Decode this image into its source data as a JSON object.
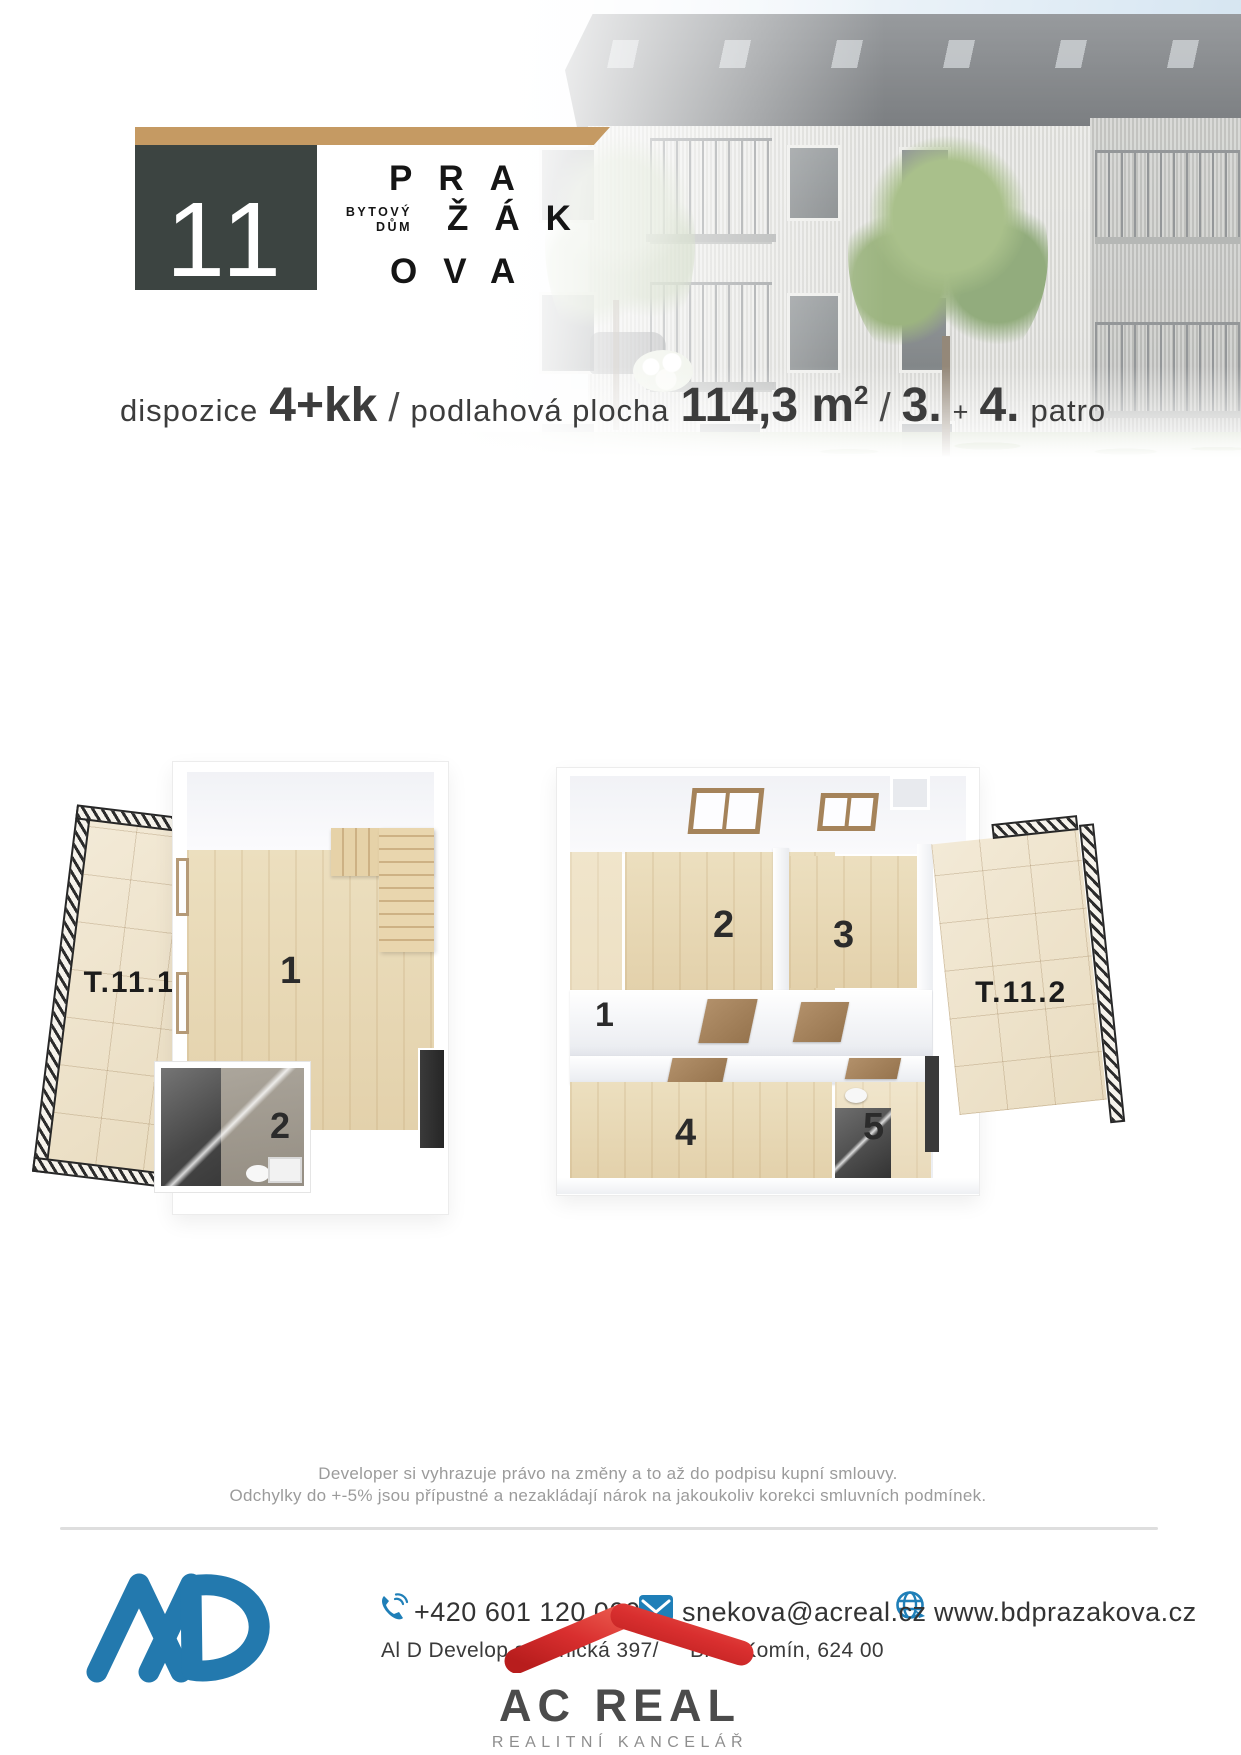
{
  "header": {
    "unit_number": "11",
    "building_type_line1": "BYTOVÝ",
    "building_type_line2": "DŮM",
    "name_row1": "PRA",
    "name_row2": "ŽÁK",
    "name_row3": "OVA",
    "accent_color": "#c59a63",
    "panel_color": "#3c4441"
  },
  "specs": {
    "layout_label": "dispozice",
    "layout_value": "4+kk",
    "slash1": "/",
    "area_label": "podlahová plocha",
    "area_value": "114,3 m",
    "area_exponent": "2",
    "slash2": "/",
    "floor_first": "3.",
    "floor_plus": "+",
    "floor_second": "4.",
    "floor_label": "patro"
  },
  "plans": {
    "terrace1_label": "T.11.1",
    "terrace2_label": "T.11.2",
    "left_room1": "1",
    "left_room2": "2",
    "right_room1": "1",
    "right_room2": "2",
    "right_room3": "3",
    "right_room4": "4",
    "right_room5": "5"
  },
  "disclaimer": {
    "line1": "Developer si vyhrazuje právo na změny a to až do podpisu kupní smlouvy.",
    "line2": "Odchylky do +-5% jsou přípustné a nezakládají nárok na jakoukoliv korekci smluvních podmínek."
  },
  "footer": {
    "phone": "+420 601 120 000",
    "email": "snekova@acreal.cz",
    "website": "www.bdprazakova.cz",
    "address_fragment1": "Al D Develop s",
    "address_fragment2": "elnická 397/",
    "address_fragment3": "Brno Komín, 624 00",
    "agency_name": "AC REAL",
    "agency_tagline": "REALITNÍ KANCELÁŘ",
    "logo_blue": "#2379ae",
    "icon_blue": "#1f7fb8",
    "roof_red": "#cf2026"
  }
}
